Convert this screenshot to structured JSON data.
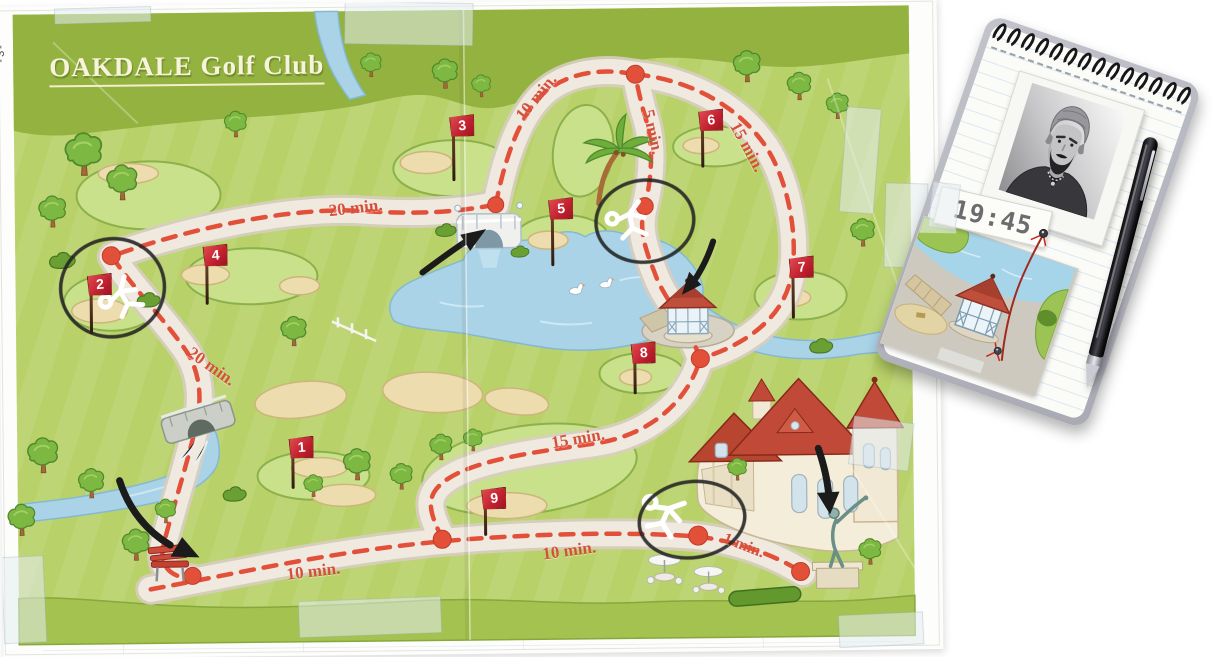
{
  "map": {
    "title": "OAKDALE Golf Club",
    "page_marker": "-3-",
    "flags": [
      {
        "number": "1"
      },
      {
        "number": "2"
      },
      {
        "number": "3"
      },
      {
        "number": "4"
      },
      {
        "number": "5"
      },
      {
        "number": "6"
      },
      {
        "number": "7"
      },
      {
        "number": "8"
      },
      {
        "number": "9"
      }
    ],
    "time_labels": [
      {
        "text": "20 min."
      },
      {
        "text": "10 min."
      },
      {
        "text": "5 min."
      },
      {
        "text": "15 min."
      },
      {
        "text": "20 min."
      },
      {
        "text": "15 min."
      },
      {
        "text": "10 min."
      },
      {
        "text": "10 min."
      },
      {
        "text": "1 min."
      }
    ],
    "landmarks": [
      "lake with swans",
      "white footbridge",
      "stone bridge with waterfall",
      "palm tree",
      "gazebo",
      "clubhouse",
      "golfer statue",
      "red bench",
      "parasol tables"
    ],
    "annotations": {
      "circled_spots": [
        "hole 2",
        "path by palm tree",
        "clubhouse forecourt"
      ],
      "chalk_body_outlines": 3,
      "arrows_point_at": [
        "footbridge",
        "gazebo",
        "bench",
        "statue"
      ]
    }
  },
  "notepad": {
    "time": "19:45",
    "items": [
      "suspect portrait photo",
      "time tag",
      "gazebo photo",
      "red string with pins",
      "ballpoint pen"
    ]
  },
  "colors": {
    "accent_red": "#e2503a",
    "flag_red": "#c01f2e",
    "map_green": "#b8d168",
    "dark_green": "#93b23f",
    "lake_blue": "#aad3e8",
    "path_beige": "#efe9e0",
    "notepad_gray": "#b7b8c0",
    "ink_black": "#1b1b1b",
    "string_red": "#a02a20"
  }
}
